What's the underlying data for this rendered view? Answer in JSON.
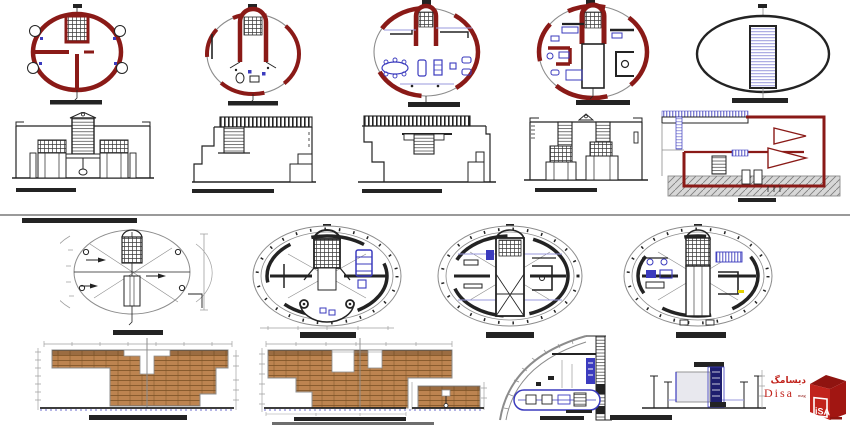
{
  "sheet": {
    "background": "#ffffff"
  },
  "colors": {
    "maroon": "#8a1a17",
    "blue": "#3b3bbe",
    "light-blue": "#9a9ade",
    "brick": "#bd8450",
    "brick-line": "#7c5226",
    "ink": "#232323",
    "gray": "#8c8c8c",
    "dim-line": "#a0a0a0",
    "foundation": "#d8d8d8",
    "found-hatch": "#808080",
    "divider": "#9a9a9a",
    "logo-red": "#c1231c",
    "logo-dark": "#8f1410",
    "navy": "#1e1e6e",
    "yellow": "#e3d100"
  },
  "logo": {
    "persian": "دیسامگ",
    "brand": "Disa",
    "suffix": "mag",
    "cube_letters": "iSA"
  }
}
